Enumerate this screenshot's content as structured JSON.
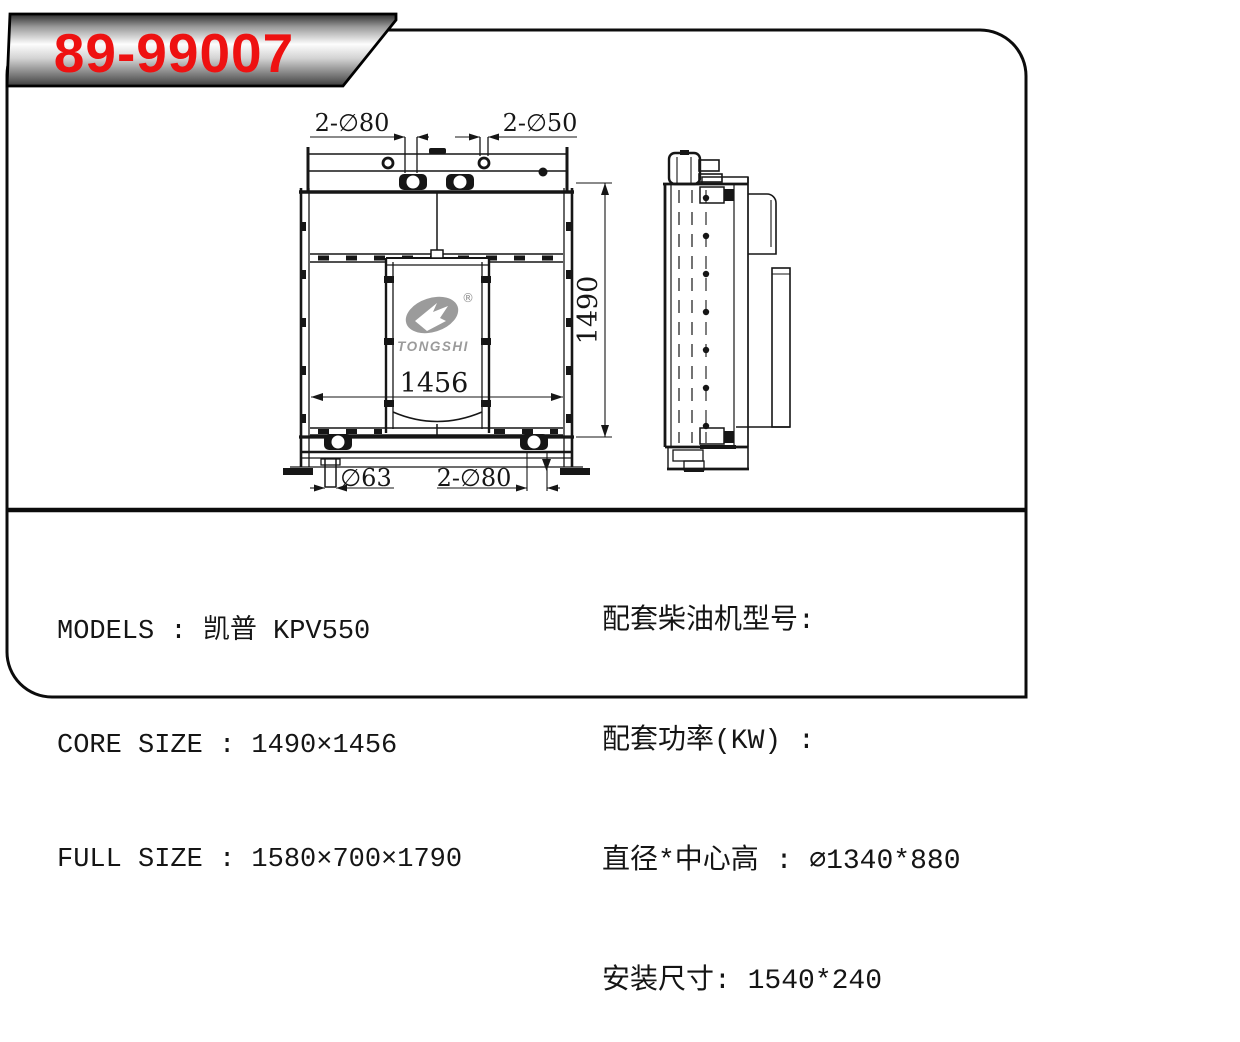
{
  "banner": {
    "part_number": "89-99007"
  },
  "logo": {
    "brand": "TONGSHI",
    "registered_mark": "®"
  },
  "dimensions": {
    "top_left_ports": "2-∅80",
    "top_right_ports": "2-∅50",
    "overall_height": "1490",
    "core_width": "1456",
    "bottom_left_pipe": "∅63",
    "bottom_ports": "2-∅80"
  },
  "specs_left": {
    "lines": [
      "MODELS : 凯普 KPV550",
      "CORE SIZE : 1490×1456",
      "FULL SIZE : 1580×700×1790"
    ]
  },
  "specs_right": {
    "lines": [
      "配套柴油机型号:",
      "配套功率(KW) :",
      "直径*中心高 : ∅1340*880",
      "安装尺寸: 1540*240"
    ]
  },
  "colors": {
    "part_number_red": "#ee1111",
    "line_black": "#161616",
    "logo_gray": "#9b9b9b"
  }
}
